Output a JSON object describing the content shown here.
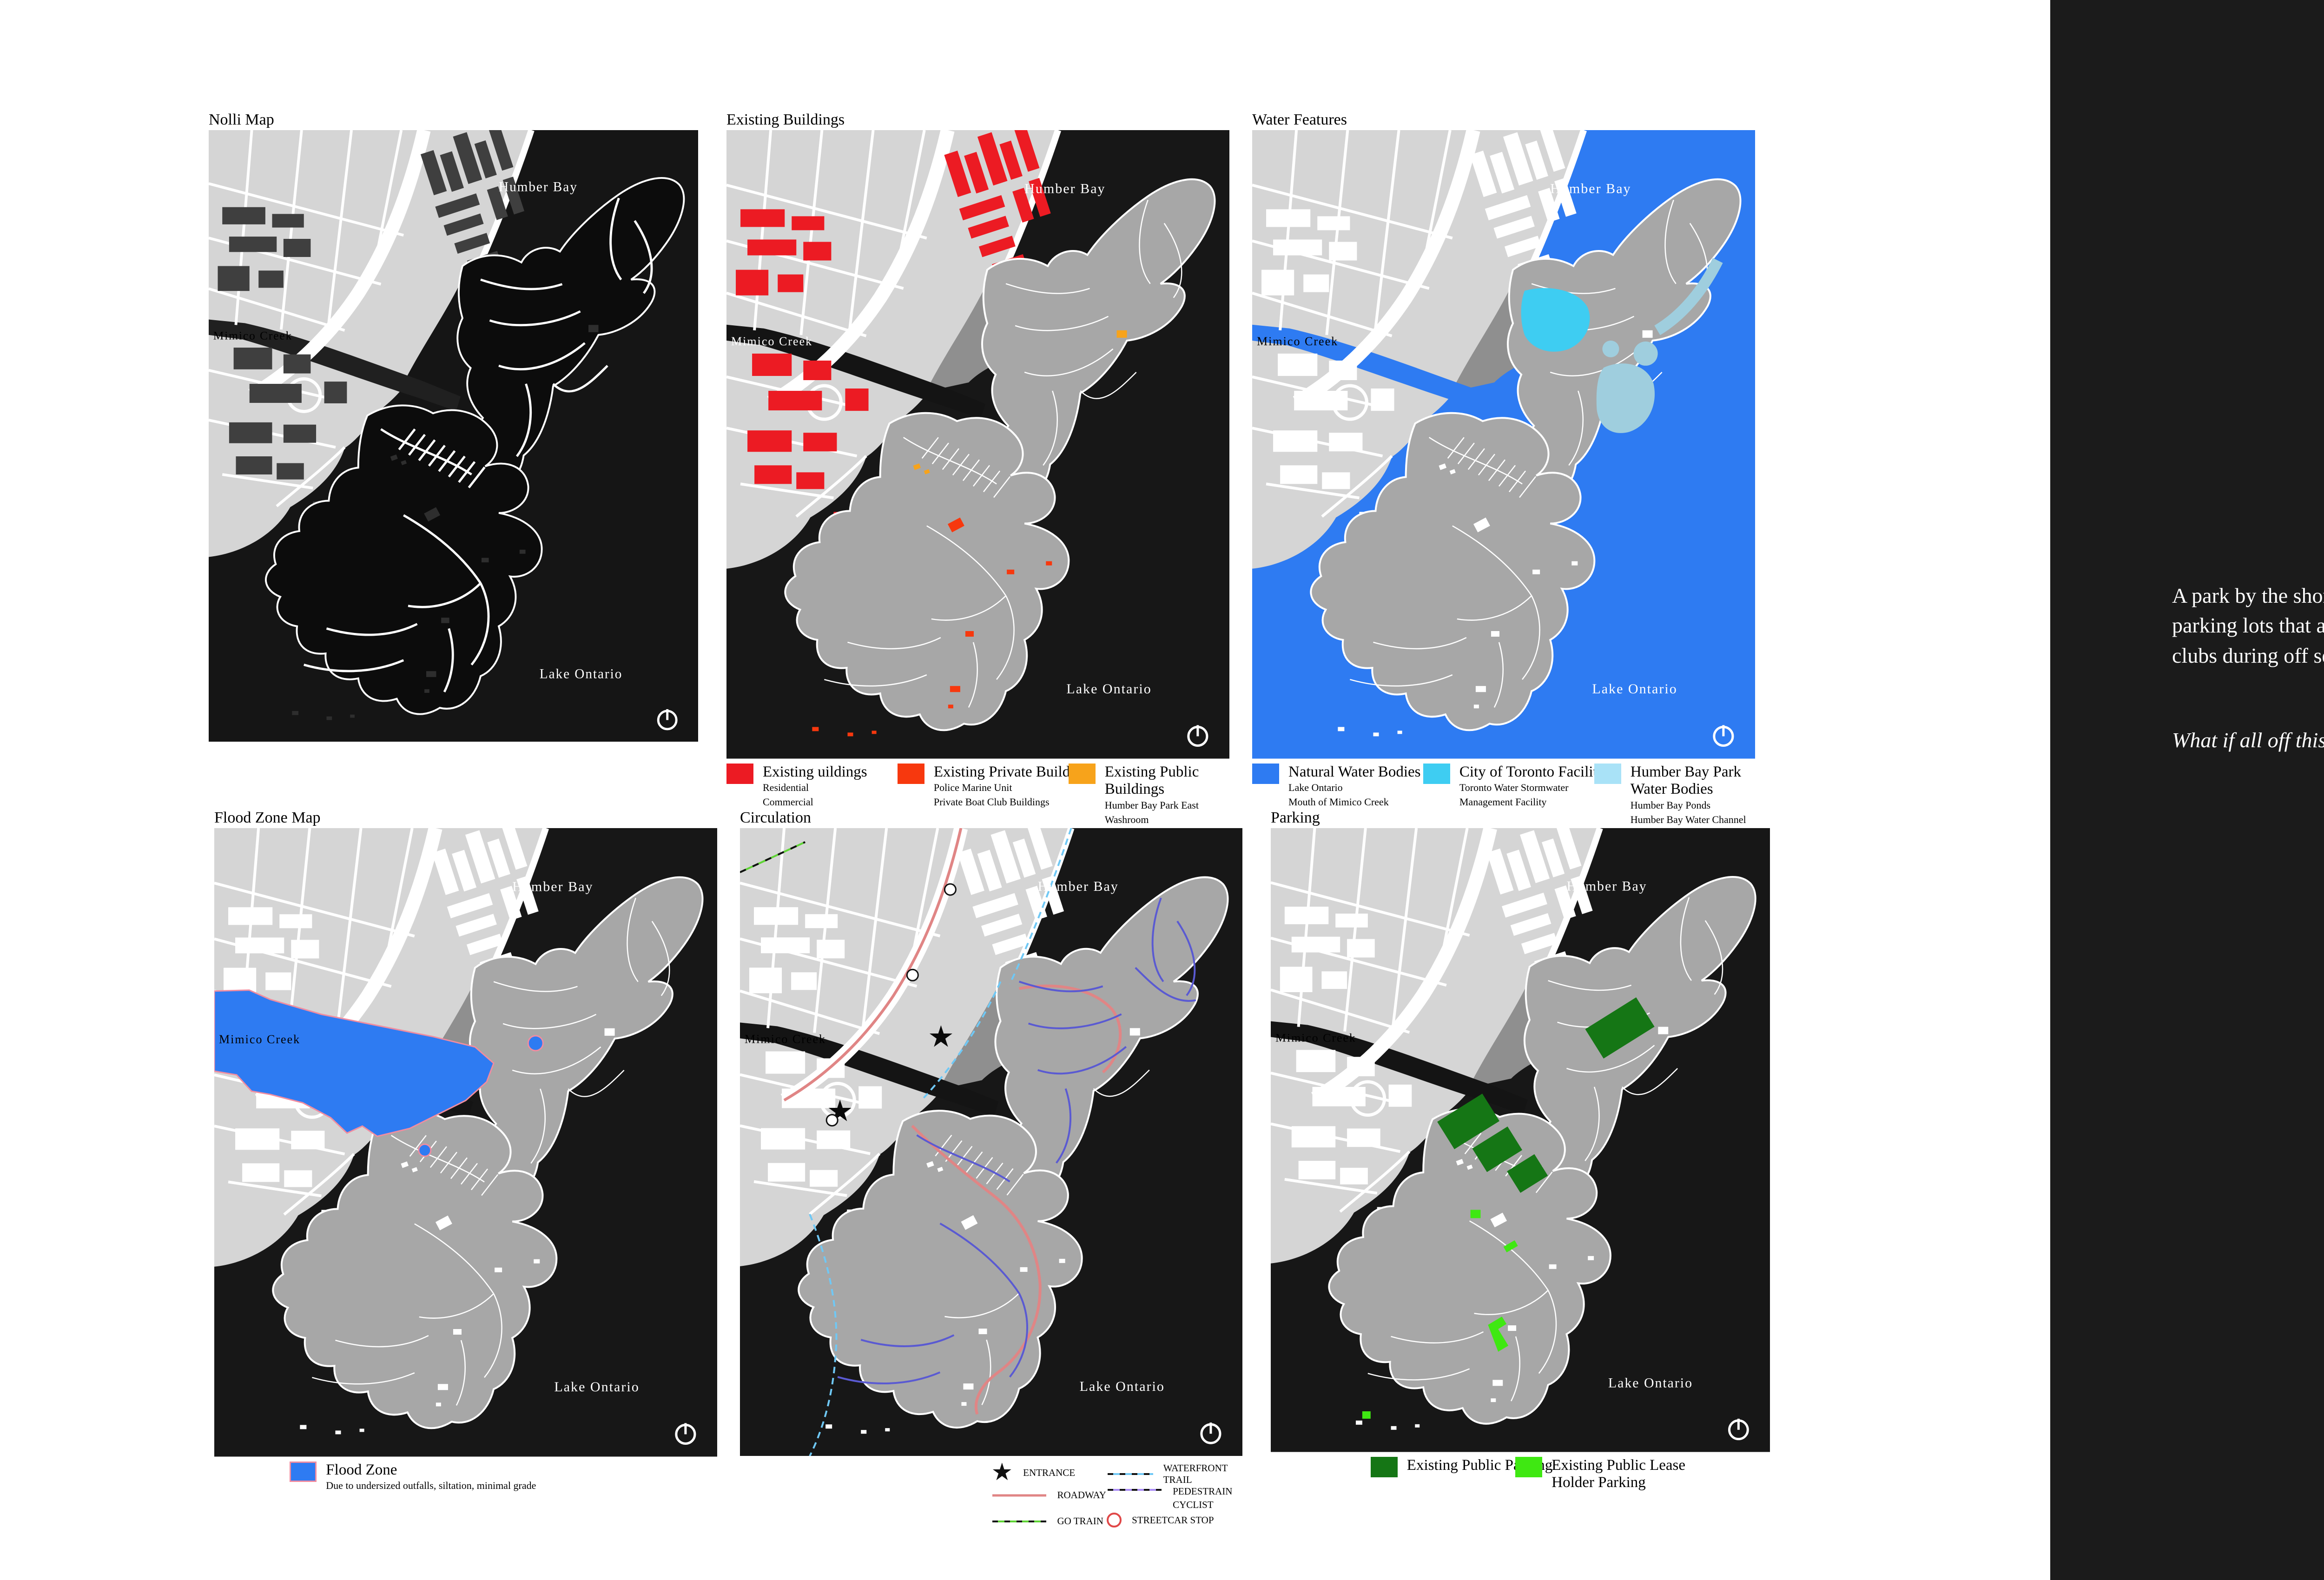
{
  "page": {
    "background": "#ffffff"
  },
  "right_panel": {
    "background": "#1b1b1b",
    "text_color": "#ffffff",
    "paragraph": "A park by the shore, exquisite yet prone to flooding in certain areas, excessive parking lots that are off-limits to visitors and a lot of unused space by the boat clubs during off season.",
    "question": "What if all off this is simply removed, and redesigned as a silent sanctuary?"
  },
  "map_labels": {
    "humber_bay": "Humber Bay",
    "mimico_creek": "Mimico Creek",
    "lake_ontario": "Lake Ontario"
  },
  "icons": {
    "entrance_star": "★",
    "north_arrow": "north-arrow"
  },
  "base_colors": {
    "water_dark": "#171717",
    "water_blue": "#2e7bf2",
    "land_gray": "#a7a7a7",
    "urban_gray": "#d5d5d5"
  },
  "maps": {
    "nolli": {
      "title": "Nolli Map"
    },
    "existing_buildings": {
      "title": "Existing Buildings",
      "legend": [
        {
          "label": "Existing uildings",
          "color": "#ec1b23",
          "sub": [
            "Residential",
            "Commercial"
          ]
        },
        {
          "label": "Existing Private Buildings",
          "color": "#f7380e",
          "sub": [
            "Police Marine Unit",
            "Private Boat Club Buildings"
          ]
        },
        {
          "label": "Existing Public Buildings",
          "color": "#f7a31b",
          "sub": [
            "Humber Bay Park East Washroom",
            "Humber Bay Park West Washroom"
          ]
        }
      ]
    },
    "water_features": {
      "title": "Water Features",
      "legend": [
        {
          "label": "Natural Water Bodies",
          "color": "#2e7bf2",
          "sub": [
            "Lake Ontario",
            "Mouth of Mimico Creek"
          ]
        },
        {
          "label": "City of Toronto Facilities",
          "color": "#3ecdf2",
          "sub": [
            "Toronto Water Stormwater",
            "Management Facility"
          ]
        },
        {
          "label": "Humber Bay Park Water Bodies",
          "color": "#a9e2f7",
          "sub": [
            "Humber Bay Ponds",
            "Humber Bay Water Channel"
          ]
        }
      ]
    },
    "flood_zone": {
      "title": "Flood Zone Map",
      "legend": [
        {
          "label": "Flood Zone",
          "color": "#2e7bf2",
          "border": "#f08ca0",
          "sub": [
            "Due to undersized outfalls, siltation, minimal grade"
          ]
        }
      ]
    },
    "circulation": {
      "title": "Circulation",
      "legend": [
        {
          "label": "ENTRANCE",
          "symbol": "star",
          "color": "#111111"
        },
        {
          "label": "ROADWAY",
          "symbol": "line",
          "color": "#e08585"
        },
        {
          "label": "GO TRAIN",
          "symbol": "dashed-line",
          "color": "#5fd435"
        },
        {
          "label": "WATERFRONT TRAIL",
          "symbol": "dashed-line",
          "color": "#6fc8f5"
        },
        {
          "label": "PEDESTRAIN",
          "label2": "CYCLIST",
          "symbol": "dashed-line",
          "color": "#a98bf5"
        },
        {
          "label": "STREETCAR STOP",
          "symbol": "ring",
          "color": "#e04848"
        }
      ]
    },
    "parking": {
      "title": "Parking",
      "legend": [
        {
          "label": "Existing Public Parking",
          "color": "#157615"
        },
        {
          "label": "Existing Public Lease Holder Parking",
          "color": "#3fe812"
        }
      ]
    }
  }
}
